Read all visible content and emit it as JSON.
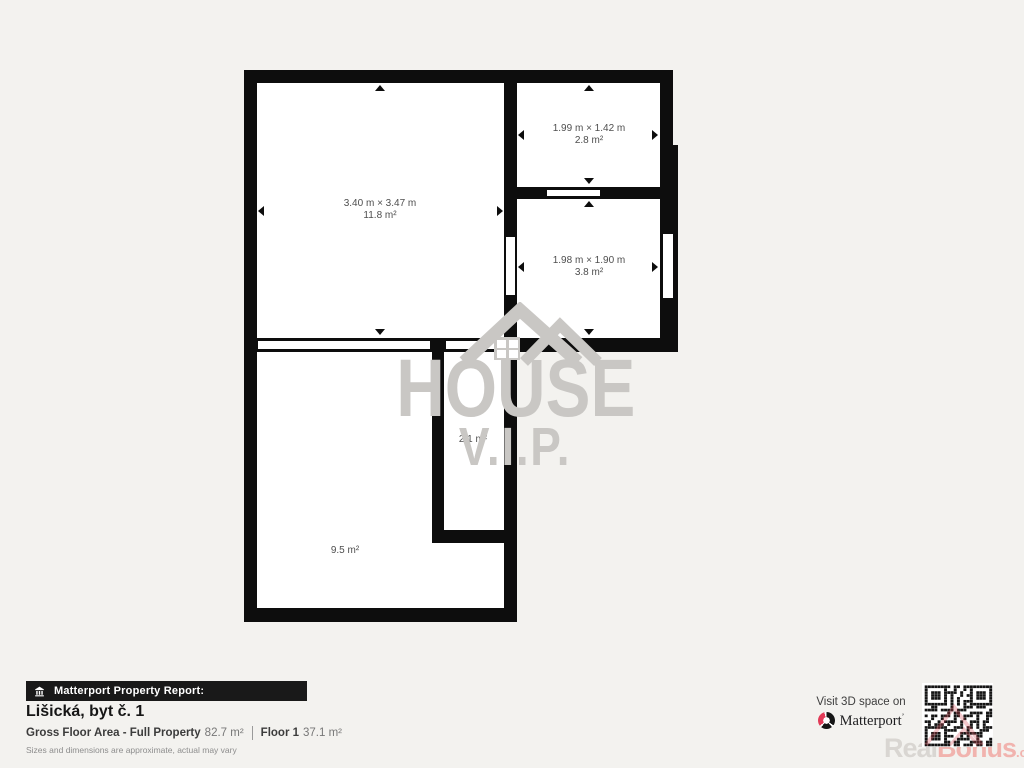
{
  "plan": {
    "rooms": {
      "living": {
        "dims": "3.40 m × 3.47 m",
        "area": "11.8 m²"
      },
      "top_right": {
        "dims": "1.99 m × 1.42 m",
        "area": "2.8 m²"
      },
      "right_middle": {
        "dims": "1.98 m × 1.90 m",
        "area": "3.8 m²"
      },
      "corridor": {
        "area": "2.1 m²"
      },
      "bottom": {
        "area": "9.5 m²"
      }
    }
  },
  "watermark": {
    "line1": "HOUSE",
    "line2": "V.I.P."
  },
  "footer": {
    "badge_label": "Matterport Property Report:",
    "title": "Lišická, byt č. 1",
    "gfa_label": "Gross Floor Area - Full Property",
    "gfa_value": "82.7 m²",
    "floor_label": "Floor 1",
    "floor_value": "37.1 m²",
    "disclaimer": "Sizes and dimensions are approximate, actual may vary"
  },
  "cta": {
    "visit_text": "Visit 3D space on",
    "brand": "Matterport",
    "brand_tick": "’"
  },
  "corner_watermark": {
    "part1": "Real",
    "part2": "Bonus",
    "suffix": ".cz"
  },
  "colors": {
    "wall_black": "#0d0d0d",
    "background": "#f3f2ef",
    "watermark_gray": "#c9c7c4",
    "matterport_pink": "#e23a57",
    "realbonus_pink": "#f1b3ae",
    "room_text": "#4e4e4e"
  }
}
